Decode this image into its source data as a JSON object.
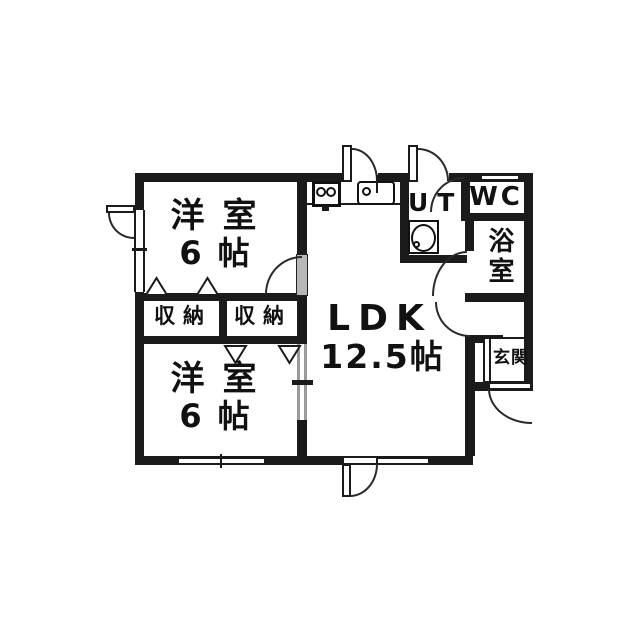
{
  "colors": {
    "wall": "#1b1b1b",
    "background": "#ffffff",
    "door_leaf_gray": "#b7b7b7",
    "line": "#2a2a2a"
  },
  "rooms": {
    "bedroom_top": {
      "name": "洋室",
      "size": "6帖"
    },
    "bedroom_bottom": {
      "name": "洋室",
      "size": "6帖"
    },
    "ldk": {
      "name": "LDK",
      "size": "12.5帖"
    },
    "utility": {
      "name": "UT"
    },
    "toilet": {
      "name": "WC"
    },
    "bath": {
      "name": "浴室"
    },
    "entrance": {
      "name": "玄関"
    },
    "closet_left": {
      "name": "収納"
    },
    "closet_right": {
      "name": "収納"
    }
  }
}
